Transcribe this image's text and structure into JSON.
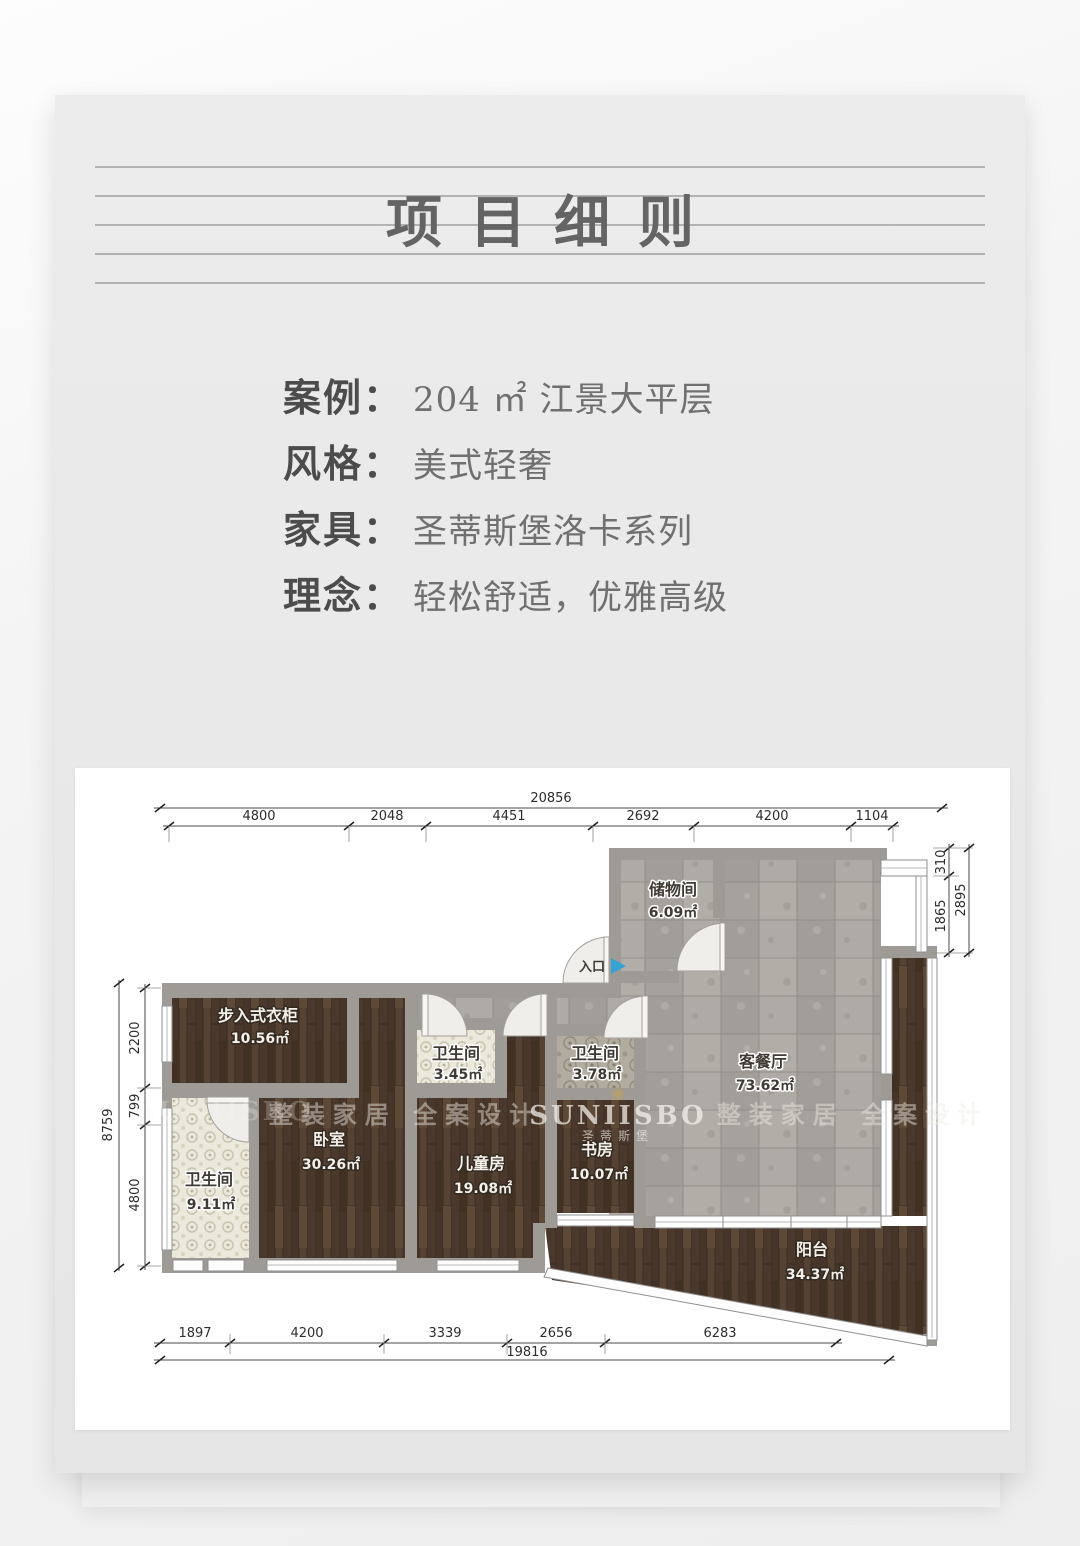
{
  "title": "项目细则",
  "info": {
    "rows": [
      {
        "label": "案例：",
        "value": "204 ㎡ 江景大平层"
      },
      {
        "label": "风格：",
        "value": "美式轻奢"
      },
      {
        "label": "家具：",
        "value": "圣蒂斯堡洛卡系列"
      },
      {
        "label": "理念：",
        "value": "轻松舒适，优雅高级"
      }
    ]
  },
  "floor_plan": {
    "entrance": {
      "label": "入口",
      "arrow_color": "#35a3d6"
    },
    "rooms": [
      {
        "id": "storage",
        "name": "储物间",
        "area": "6.09㎡"
      },
      {
        "id": "living-dining",
        "name": "客餐厅",
        "area": "73.62㎡"
      },
      {
        "id": "walk-in-closet",
        "name": "步入式衣柜",
        "area": "10.56㎡"
      },
      {
        "id": "bedroom",
        "name": "卧室",
        "area": "30.26㎡"
      },
      {
        "id": "bathroom-left",
        "name": "卫生间",
        "area": "9.11㎡"
      },
      {
        "id": "bathroom-middle",
        "name": "卫生间",
        "area": "3.45㎡"
      },
      {
        "id": "children-room",
        "name": "儿童房",
        "area": "19.08㎡"
      },
      {
        "id": "bathroom-right",
        "name": "卫生间",
        "area": "3.78㎡"
      },
      {
        "id": "study",
        "name": "书房",
        "area": "10.07㎡"
      },
      {
        "id": "balcony",
        "name": "阳台",
        "area": "34.37㎡"
      }
    ],
    "dimensions": {
      "top_total": "20856",
      "top_segments": [
        "4800",
        "2048",
        "4451",
        "2692",
        "4200",
        "1104"
      ],
      "bottom_segments": [
        "1897",
        "4200",
        "3339",
        "2656",
        "6283"
      ],
      "bottom_total": "19816",
      "left_total": "8759",
      "left_segments": [
        "2200",
        "799",
        "4800"
      ],
      "right_segments": [
        "310",
        "1865"
      ],
      "right_total": "2895"
    },
    "watermarks": {
      "brand": "SUNIISBO",
      "brand_cn": "圣蒂斯堡",
      "slogan": "整装家居 全案设计"
    },
    "colors": {
      "wood": "#4e3c30",
      "tile": "#a8a49f",
      "wall": "#9e9b97",
      "entry_arrow": "#35a3d6"
    }
  }
}
